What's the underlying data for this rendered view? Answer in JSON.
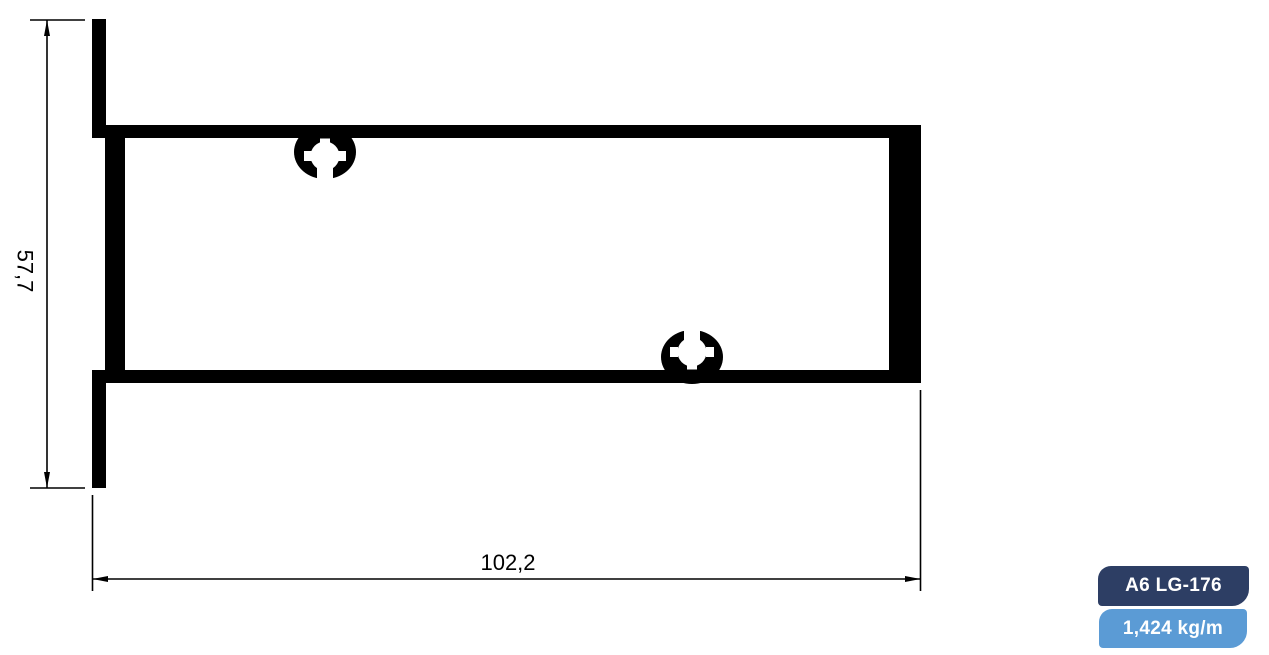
{
  "dimensions": {
    "height_label": "57,7",
    "width_label": "102,2"
  },
  "badges": {
    "profile_code": "A6 LG-176",
    "weight": "1,424 kg/m"
  },
  "colors": {
    "profile_ink": "#000000",
    "cutout_white": "#ffffff",
    "badge_code_bg": "#2d3e64",
    "badge_weight_bg": "#5b9bd5",
    "badge_text": "#ffffff",
    "background": "#ffffff"
  }
}
